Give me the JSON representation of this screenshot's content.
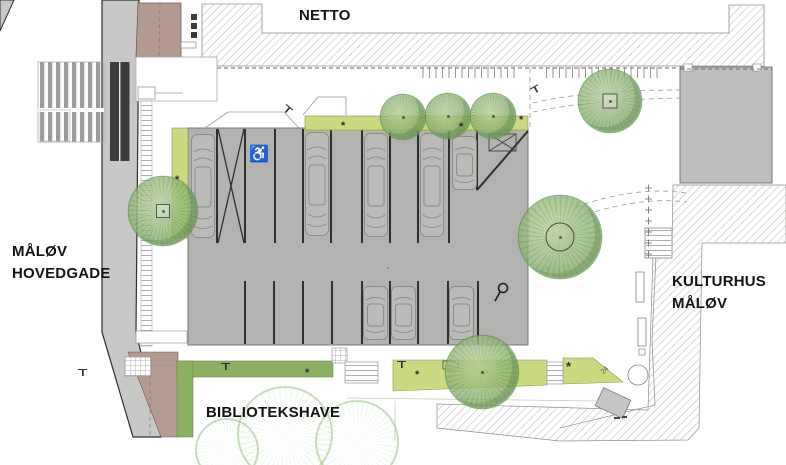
{
  "plan": {
    "type": "architectural site plan",
    "area_names": [
      "NETTO",
      "MÅLØV HOVEDGADE",
      "KULTURHUS MÅLØV",
      "BIBLIOTEKSHAVE"
    ]
  },
  "labels": {
    "netto": "NETTO",
    "street_line1": "MÅLØV",
    "street_line2": "HOVEDGADE",
    "kulturhus_line1": "KULTURHUS",
    "kulturhus_line2": "MÅLØV",
    "garden": "BIBLIOTEKSHAVE"
  },
  "glyphs": {
    "accessible_parking": "♿",
    "plant_mark": "*",
    "rotated_mark": "24"
  },
  "colors": {
    "road": "#c8c8c6",
    "road_marking": "#3c3c3c",
    "crosswalk_stripe": "#9b9b99",
    "parking_surface": "#b2b2b0",
    "building_gray": "#bdbdbb",
    "building_brown": "#b29a90",
    "plaza_brown": "#b59a92",
    "planting_light": "#cbd980",
    "planting_dark": "#8cb061",
    "tree_green": "#8fb573",
    "tree_edge": "#5f9553",
    "hatch_line": "#b3b1ad",
    "line_dark": "#2f2f2d"
  }
}
